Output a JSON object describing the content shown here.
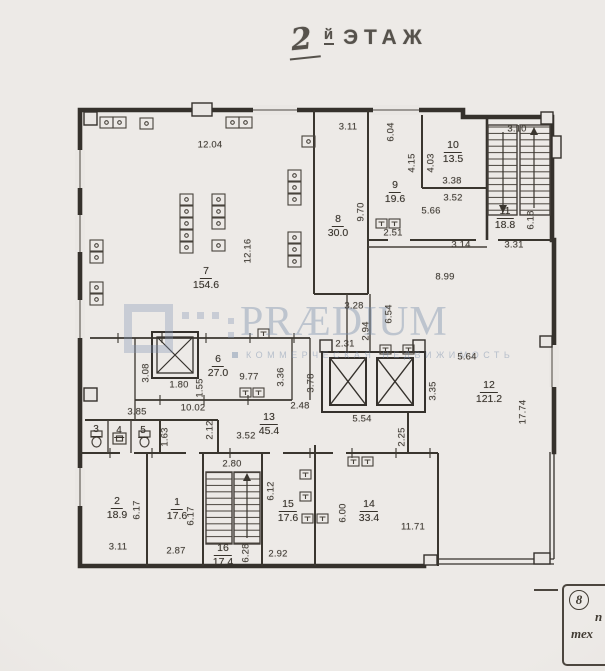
{
  "title": {
    "handwritten_number": "2",
    "suffix_small": "й",
    "suffix_word": "ЭТАЖ"
  },
  "watermark": {
    "brand": "PRÆDIUM",
    "subtitle": "КОММЕРЧЕСКАЯ НЕДВИЖИМОСТЬ",
    "accent_color": "#7b8eab"
  },
  "stamp": {
    "number": "8",
    "line1": "п",
    "line2": "тех"
  },
  "colors": {
    "paper": "#eae7e4",
    "ink": "#35312c"
  },
  "rooms": [
    {
      "num": "7",
      "area": "154.6"
    },
    {
      "num": "8",
      "area": "30.0"
    },
    {
      "num": "9",
      "area": "19.6"
    },
    {
      "num": "10",
      "area": "13.5"
    },
    {
      "num": "11",
      "area": "18.8"
    },
    {
      "num": "12",
      "area": "121.2"
    },
    {
      "num": "6",
      "area": "27.0"
    },
    {
      "num": "13",
      "area": "45.4"
    },
    {
      "num": "2",
      "area": "18.9"
    },
    {
      "num": "1",
      "area": "17.6"
    },
    {
      "num": "16",
      "area": "17.4"
    },
    {
      "num": "15",
      "area": "17.6"
    },
    {
      "num": "14",
      "area": "33.4"
    },
    {
      "num": "3"
    },
    {
      "num": "4"
    },
    {
      "num": "5"
    }
  ],
  "dims": [
    "12.04",
    "3.11",
    "6.04",
    "4.15",
    "4.03",
    "3.38",
    "3.52",
    "5.66",
    "2.51",
    "9.70",
    "3.10",
    "6.18",
    "3.14",
    "3.31",
    "8.99",
    "12.16",
    "3.28",
    "6.54",
    "2.94",
    "2.31",
    "5.64",
    "3.35",
    "17.74",
    "3.08",
    "1.80",
    "1.55",
    "9.77",
    "3.36",
    "3.78",
    "2.48",
    "10.02",
    "5.54",
    "2.25",
    "3.85",
    "1.63",
    "2.12",
    "3.52",
    "2.80",
    "6.17",
    "6.17",
    "3.11",
    "2.87",
    "6.28",
    "6.12",
    "2.92",
    "6.00",
    "11.71"
  ]
}
